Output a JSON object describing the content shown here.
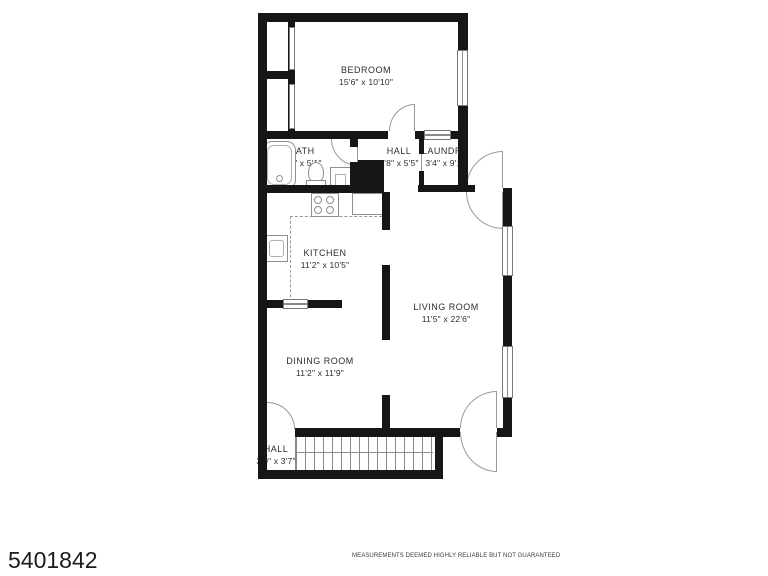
{
  "plan": {
    "listing_id": "5401842",
    "disclaimer": "MEASUREMENTS DEEMED HIGHLY RELIABLE BUT NOT GUARANTEED",
    "rooms": [
      {
        "name": "BEDROOM",
        "dims": "15'6\" x 10'10\""
      },
      {
        "name": "BATH",
        "dims": "8'9\" x 5'1\""
      },
      {
        "name": "HALL",
        "dims": "5'8\" x 5'5\""
      },
      {
        "name": "LAUNDRY",
        "dims": "3'4\" x 9'1\""
      },
      {
        "name": "KITCHEN",
        "dims": "11'2\" x 10'5\""
      },
      {
        "name": "LIVING ROOM",
        "dims": "11'5\" x 22'6\""
      },
      {
        "name": "DINING ROOM",
        "dims": "11'2\" x 11'9\""
      },
      {
        "name": "HALL",
        "dims": "3'0\" x 3'7\""
      }
    ],
    "colors": {
      "wall": "#161616",
      "fixture_line": "#8f8f8f",
      "label_text": "#2d2d2d"
    }
  }
}
